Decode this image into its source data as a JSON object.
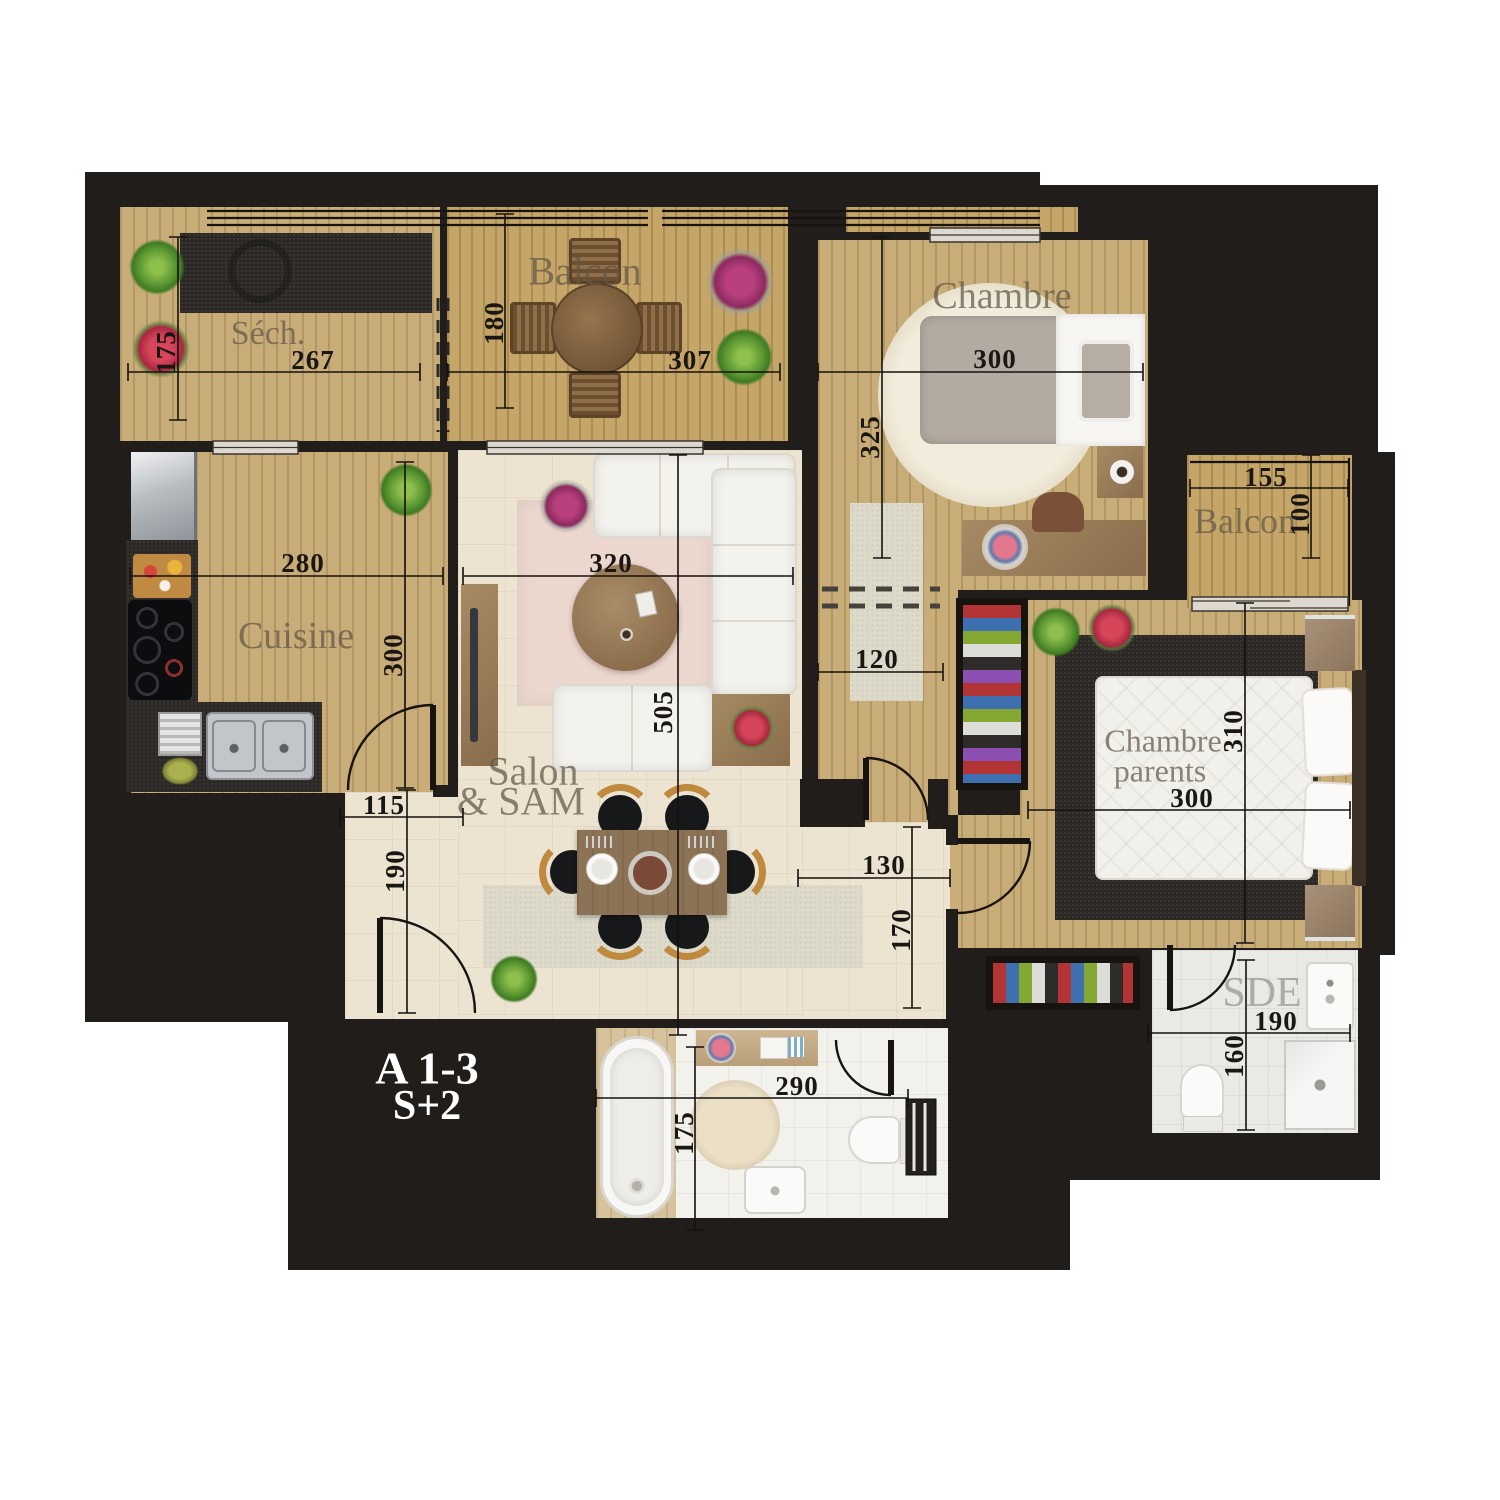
{
  "plan": {
    "unit": "A 1-3",
    "type": "S+2"
  },
  "rooms": {
    "sech": "Séch.",
    "balcon_top": "Balcon",
    "chambre": "Chambre",
    "balcon_right": "Balcon",
    "cuisine": "Cuisine",
    "salon_line1": "Salon",
    "salon_line2": "& SAM",
    "parents_line1": "Chambre",
    "parents_line2": "parents",
    "sde": "SDE"
  },
  "dims": {
    "sech_w": "267",
    "sech_h": "175",
    "balcon_top_h": "180",
    "balcon_top_w": "307",
    "chambre_w": "300",
    "chambre_h": "325",
    "balcon_right_w": "155",
    "balcon_right_h": "100",
    "cuisine_w": "280",
    "cuisine_h": "300",
    "salon_w": "320",
    "salon_h": "505",
    "entry_w": "115",
    "entry_h": "190",
    "hall_w": "120",
    "corridor_w": "130",
    "corridor_h": "170",
    "parents_h": "310",
    "parents_w": "300",
    "sde_w": "190",
    "sde_h": "160",
    "sdb_w": "290",
    "sdb_h": "175"
  },
  "colors": {
    "backdrop": "#211d1a",
    "wood": "#c9ad78",
    "label": "#60564.6"
  }
}
